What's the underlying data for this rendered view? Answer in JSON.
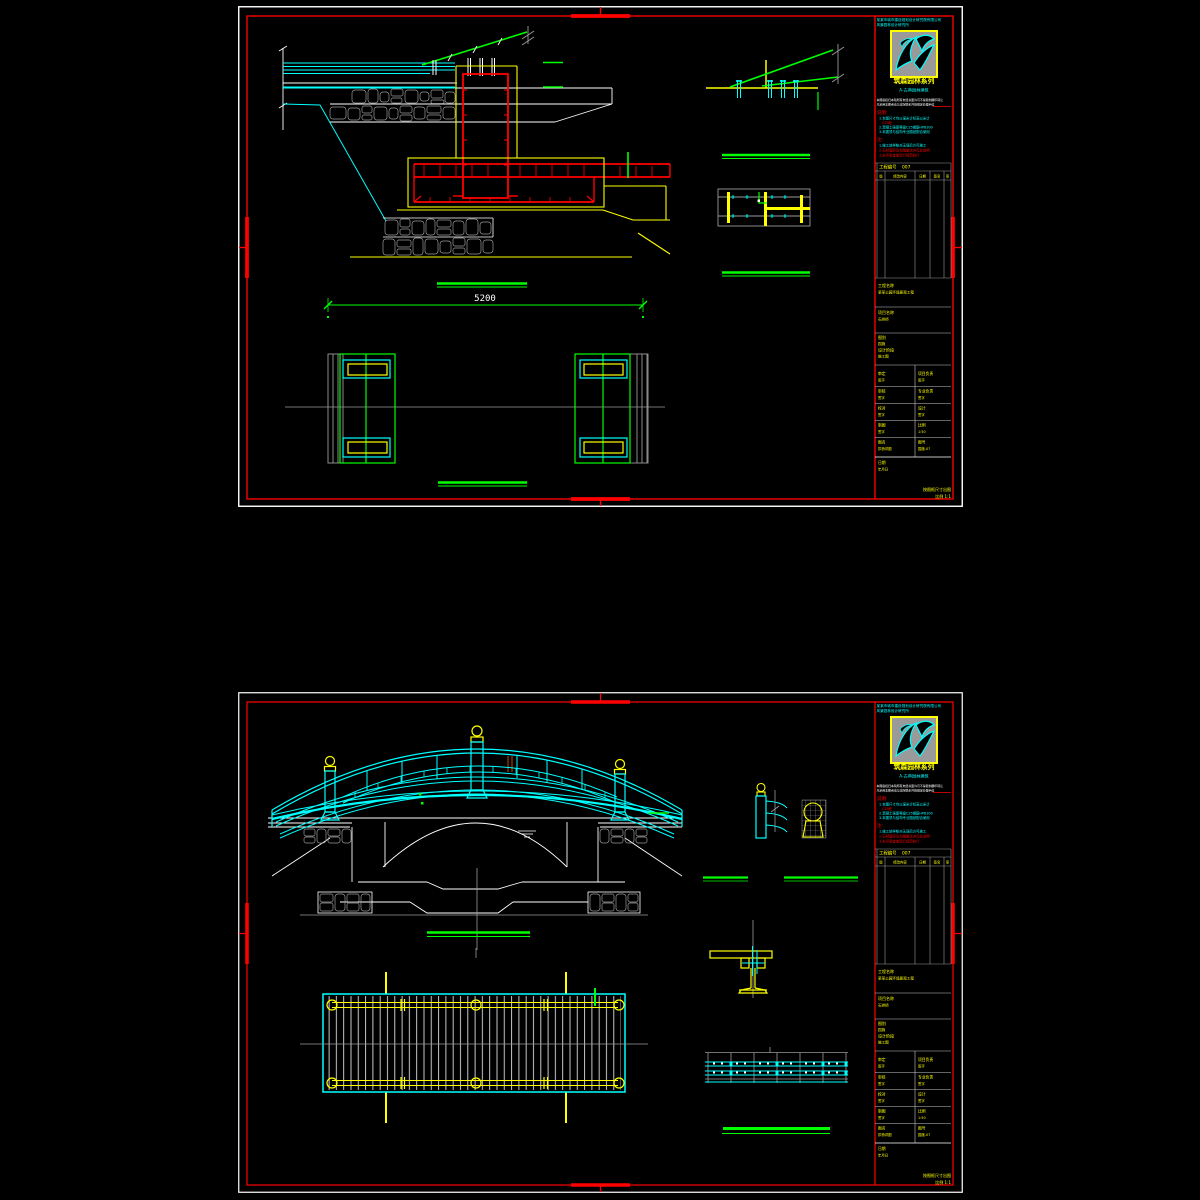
{
  "app": {
    "description": "CAD drawing viewer - two garden stone arch bridge construction drawing sheets",
    "background": "#000000"
  },
  "colors": {
    "border_red": "#ff0000",
    "line_cyan": "#00ffff",
    "line_green": "#00ff00",
    "line_yellow": "#ffff00",
    "line_white": "#ffffff",
    "line_gray": "#9a9a9a",
    "logo_bg": "#9a9a9a",
    "logo_border": "#ffff00"
  },
  "sheet1": {
    "dimension_label": "5200"
  },
  "titleblock": {
    "company_line1": "某某市城市建设规划设计研究院有限公司",
    "company_line2": "风景园林设计研究所",
    "series_title": "筑森园林系列",
    "series_subtitle": "A-古典园林建筑",
    "copyright_line1": "本图版权归本院所有未经书面许可不得复制翻印转让",
    "copyright_line2": "凡采用本图者请与本院联系并按规定办理手续",
    "notes_title": "说明:",
    "note1": "1.本图尺寸均以毫米计标高以米计",
    "note1b": "C25砼",
    "note2": "2.混凝土强度等级C25钢筋HPB300",
    "note3": "3.本图须与结构专业图纸配合使用",
    "notes2_title": "注:",
    "notes2_line1": "1.施工放样核对无误后方可施工",
    "notes2_line2": "2.石材面层及勾缝做法详见总说明",
    "notes2_line3": "3.未尽事宜按现行规范执行",
    "table_title": "工程编号",
    "table_no": "007",
    "table_headers": [
      "版",
      "修改内容",
      "日期",
      "签名",
      "审"
    ],
    "fields": {
      "f1_label": "工程名称",
      "f1_value": "某某公园环境景观工程",
      "f2_label": "项目名称",
      "f2_value": "石拱桥",
      "f3_label": "图别",
      "f3_value": "园施",
      "f4_label": "设计阶段",
      "f4_value": "施工图",
      "f10_label": "日期",
      "f10_value": "年月日"
    },
    "approval_rows": [
      {
        "ll": "审定",
        "lv": "签字",
        "rl": "项目负责",
        "rv": "签字"
      },
      {
        "ll": "审核",
        "lv": "签字",
        "rl": "专业负责",
        "rv": "签字"
      },
      {
        "ll": "校对",
        "lv": "签字",
        "rl": "设计",
        "rv": "签字"
      },
      {
        "ll": "制图",
        "lv": "签字",
        "rl": "比例",
        "rv": "1:50"
      },
      {
        "ll": "图名",
        "lv": "拱桥详图",
        "rl": "图号",
        "rv": "园施-07"
      }
    ],
    "plot_note_line1": "按图框尺寸出图",
    "plot_note_line2": "比例 1:1"
  }
}
